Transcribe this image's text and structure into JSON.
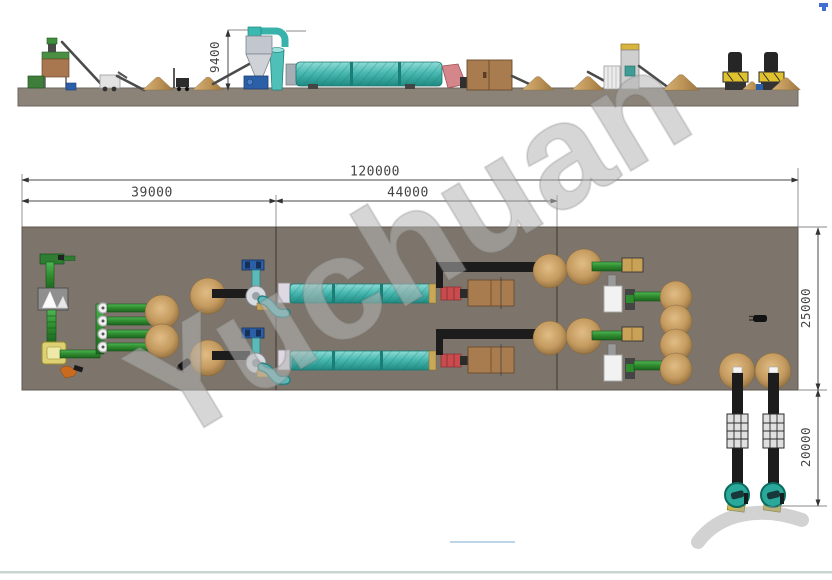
{
  "watermark": {
    "text": "Yuchuan"
  },
  "dimensions": {
    "overall_length": {
      "label": "120000",
      "orientation": "horizontal",
      "view": "plan"
    },
    "section_left": {
      "label": "39000",
      "orientation": "horizontal",
      "view": "plan"
    },
    "section_middle": {
      "label": "44000",
      "orientation": "horizontal",
      "view": "plan"
    },
    "plan_depth": {
      "label": "25000",
      "orientation": "vertical",
      "view": "plan"
    },
    "cooling_depth": {
      "label": "20000",
      "orientation": "vertical",
      "view": "plan"
    },
    "elevation_height": {
      "label": "9400",
      "orientation": "vertical",
      "view": "elevation"
    }
  },
  "colors": {
    "plan_floor": "#7d756b",
    "elevation_ground": "#8b8378",
    "drum_teal": "#49b9b1",
    "conveyor_green": "#2e8b2e",
    "black_conveyor": "#1c1c1c",
    "material_pile": "#c49a5f",
    "furnace_brown": "#a87c4e",
    "drum_inlet_red": "#c94b4e",
    "mixer_yellow": "#ded173",
    "fan_blue": "#2b5fa8",
    "dimension_line": "#4a4a4a"
  },
  "views": {
    "elevation": {
      "equipment": [
        "batching-hopper",
        "bucket-elevator",
        "inclined-conveyor",
        "crusher-cart",
        "material-pile",
        "forklift",
        "cyclone-separator",
        "draft-fan",
        "exhaust-duct",
        "rotary-drum-dryer",
        "drum-inlet-elbow",
        "hot-air-furnace",
        "bag-filter",
        "granulation-tower",
        "pellet-press-1",
        "pellet-press-2"
      ]
    },
    "plan": {
      "equipment": [
        "feeder-head",
        "crusher-box",
        "chain-mill",
        "mixer",
        "distribution-screw-conveyors",
        "material-piles",
        "feed-belt-conveyor",
        "cyclone-and-fan",
        "rotary-drum-line-1",
        "rotary-drum-line-2",
        "hot-air-furnace-1",
        "hot-air-furnace-2",
        "screening-machine",
        "packing-machine",
        "output-conveyor",
        "cooling-conveyor-1",
        "cooling-conveyor-2",
        "coating-machine-1",
        "coating-machine-2",
        "worker",
        "roller"
      ]
    }
  }
}
